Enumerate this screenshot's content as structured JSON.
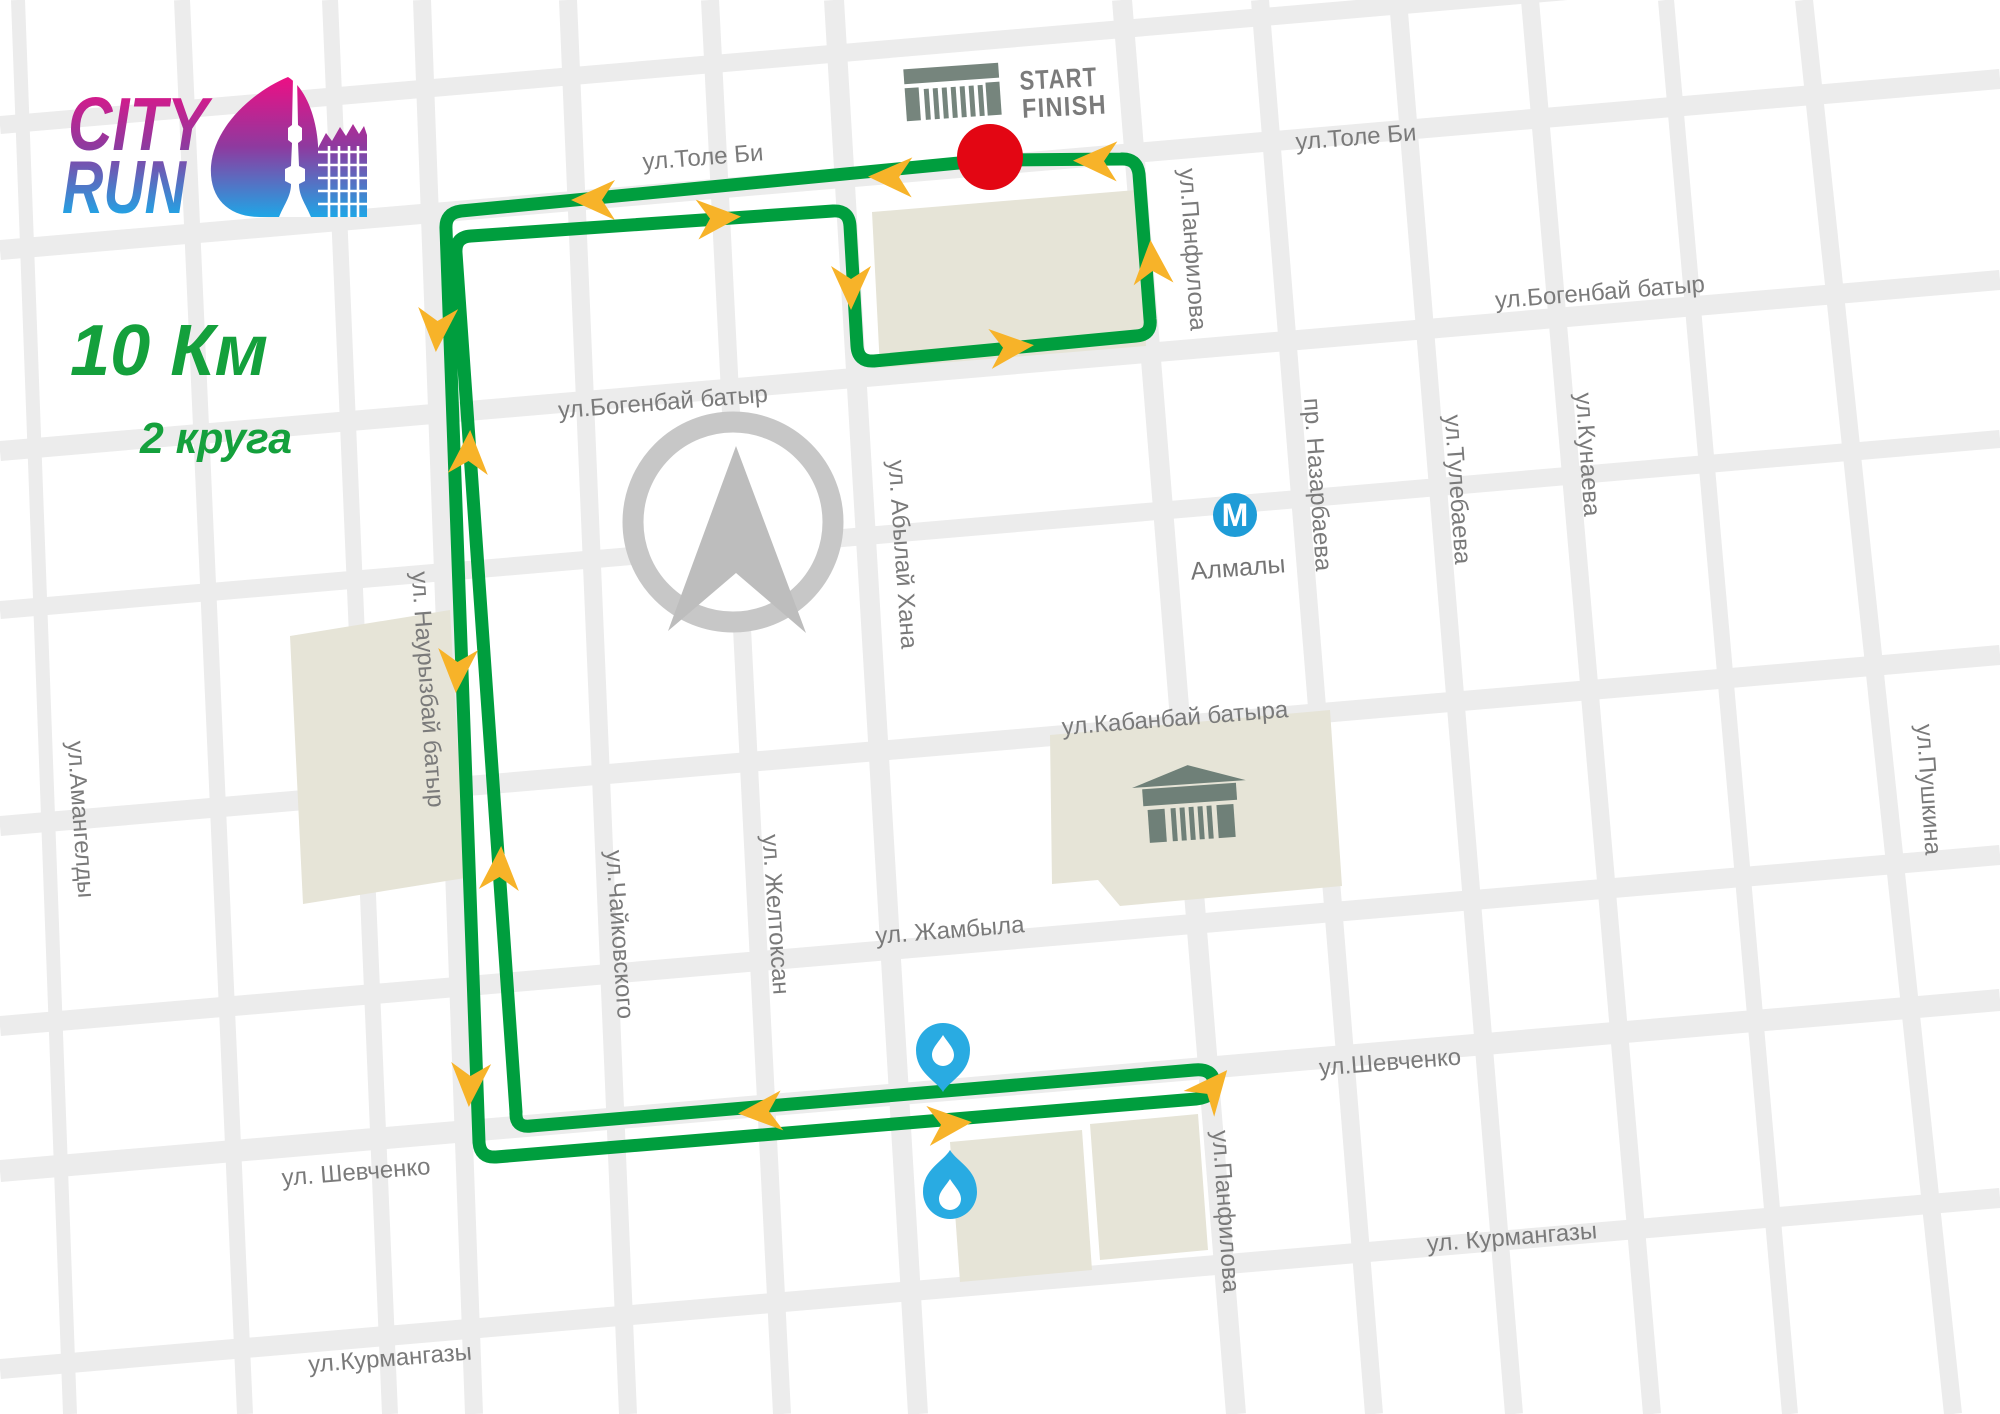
{
  "logo": {
    "word1": "CITY",
    "word2": "RUN"
  },
  "course": {
    "distance": "10 Км",
    "laps": "2 круга"
  },
  "start_finish": {
    "line1": "START",
    "line2": "FINISH"
  },
  "metro": {
    "symbol": "М",
    "station": "Алмалы"
  },
  "streets": {
    "h_labels": [
      "ул.Толе Би",
      "ул.Толе Би",
      "ул.Богенбай батыр",
      "ул.Богенбай батыр",
      "ул.Кабанбай батыра",
      "ул. Жамбыла",
      "ул. Шевченко",
      "ул.Шевченко",
      "ул.Курмангазы",
      "ул. Курмангазы"
    ],
    "v_labels": [
      "ул.Амангелды",
      "ул. Наурызбай батыр",
      "ул.Чайковского",
      "ул. Желтоксан",
      "ул. Абылай Хана",
      "ул.Панфилова",
      "ул.Панфилова",
      "пр. Назарбаева",
      "ул.Тулебаева",
      "ул.Кунаева",
      "ул.Пушкина"
    ]
  },
  "icons": {
    "start_gate": "start-gate-icon",
    "opera_house": "opera-house-icon",
    "compass": "compass-icon",
    "water_station": "water-station-icon",
    "metro": "metro-icon",
    "start_dot": "start-finish-dot",
    "route_arrow": "route-direction-arrow"
  },
  "colors": {
    "route_green": "#009E3E",
    "arrow_yellow": "#F7B329",
    "start_red": "#E30613",
    "water_blue": "#29ABE2",
    "metro_blue": "#1E9CD7",
    "street_gray": "#ECECEC",
    "block_beige": "#E6E4D7",
    "label_gray": "#7A7A7A",
    "icon_slate": "#76857D",
    "logo_magenta": "#ED0F84",
    "logo_blue": "#1FA6E6",
    "text_green": "#14A03C"
  }
}
